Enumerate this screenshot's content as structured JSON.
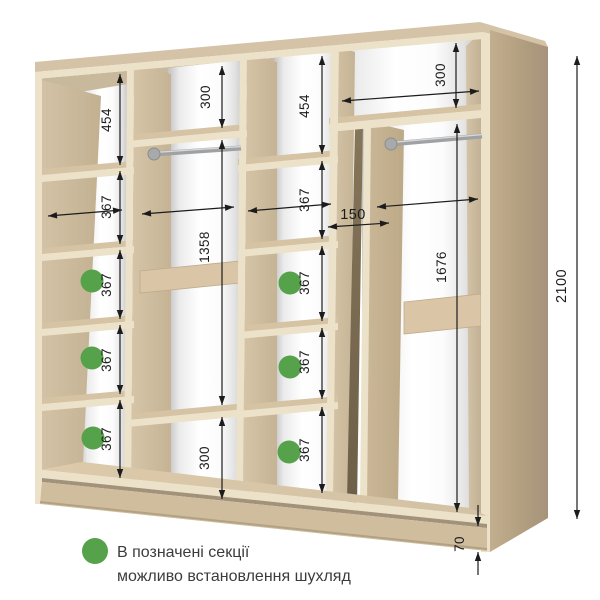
{
  "dimensions": {
    "column_a": [
      "454",
      "367",
      "367",
      "367",
      "367"
    ],
    "column_b": [
      "300",
      "1358",
      "300"
    ],
    "column_c": [
      "454",
      "367",
      "367",
      "367",
      "367"
    ],
    "column_d": [
      "300",
      "1676"
    ],
    "slot_width": "150",
    "total_height": "2100",
    "plinth_height": "70"
  },
  "legend": {
    "line1": "В позначені секції",
    "line2": "можливо встановлення шухляд"
  },
  "colors": {
    "marker_green": "#55a24a",
    "wood_face": "#cdbc9f",
    "wood_edge": "#ece1c9",
    "wood_side_panel": "#b3a081",
    "dimension_ink": "#1c1c1c"
  }
}
